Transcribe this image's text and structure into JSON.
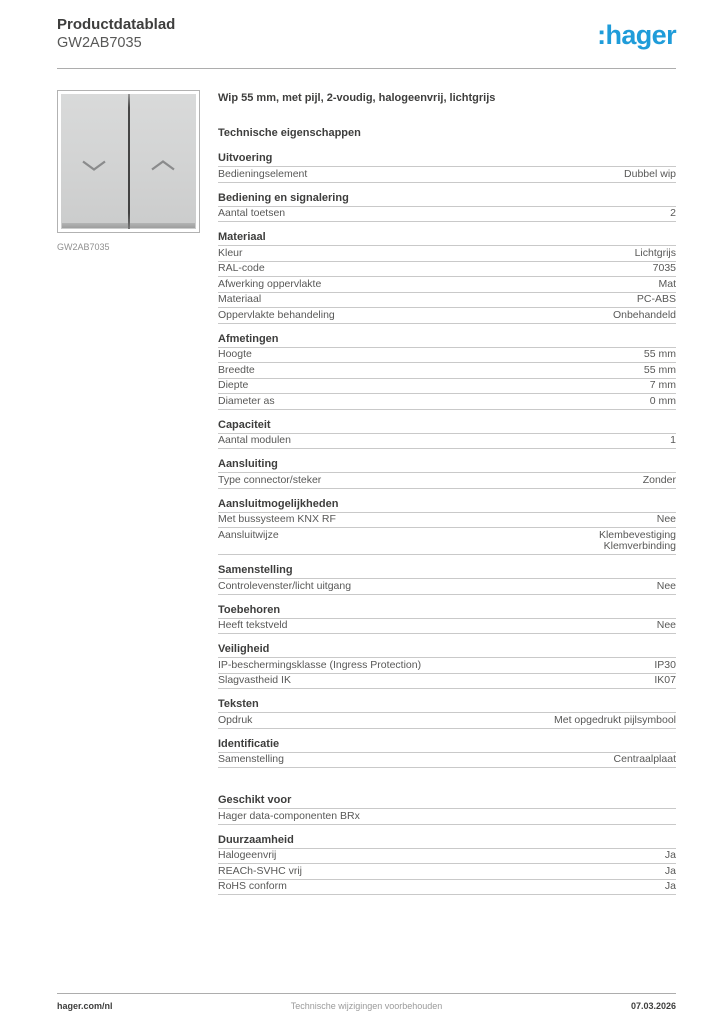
{
  "header": {
    "title": "Productdatablad",
    "product_code": "GW2AB7035",
    "logo": ":hager"
  },
  "product": {
    "image_caption": "GW2AB7035",
    "image_icons": [
      "chevron-down-icon",
      "chevron-up-icon"
    ],
    "description": "Wip 55 mm, met pijl, 2-voudig, halogeenvrij, lichtgrijs",
    "tech_title": "Technische eigenschappen"
  },
  "sections": [
    {
      "title": "Uitvoering",
      "rows": [
        {
          "label": "Bedieningselement",
          "value": "Dubbel wip"
        }
      ]
    },
    {
      "title": "Bediening en signalering",
      "rows": [
        {
          "label": "Aantal toetsen",
          "value": "2"
        }
      ]
    },
    {
      "title": "Materiaal",
      "rows": [
        {
          "label": "Kleur",
          "value": "Lichtgrijs"
        },
        {
          "label": "RAL-code",
          "value": "7035"
        },
        {
          "label": "Afwerking oppervlakte",
          "value": "Mat"
        },
        {
          "label": "Materiaal",
          "value": "PC-ABS"
        },
        {
          "label": "Oppervlakte behandeling",
          "value": "Onbehandeld"
        }
      ]
    },
    {
      "title": "Afmetingen",
      "rows": [
        {
          "label": "Hoogte",
          "value": "55 mm"
        },
        {
          "label": "Breedte",
          "value": "55 mm"
        },
        {
          "label": "Diepte",
          "value": "7 mm"
        },
        {
          "label": "Diameter as",
          "value": "0 mm"
        }
      ]
    },
    {
      "title": "Capaciteit",
      "rows": [
        {
          "label": "Aantal modulen",
          "value": "1"
        }
      ]
    },
    {
      "title": "Aansluiting",
      "rows": [
        {
          "label": "Type connector/steker",
          "value": "Zonder"
        }
      ]
    },
    {
      "title": "Aansluitmogelijkheden",
      "rows": [
        {
          "label": "Met bussysteem KNX RF",
          "value": "Nee"
        },
        {
          "label": "Aansluitwijze",
          "value": "Klembevestiging\nKlemverbinding"
        }
      ]
    },
    {
      "title": "Samenstelling",
      "rows": [
        {
          "label": "Controlevenster/licht uitgang",
          "value": "Nee"
        }
      ]
    },
    {
      "title": "Toebehoren",
      "rows": [
        {
          "label": "Heeft tekstveld",
          "value": "Nee"
        }
      ]
    },
    {
      "title": "Veiligheid",
      "rows": [
        {
          "label": "IP-beschermingsklasse (Ingress Protection)",
          "value": "IP30"
        },
        {
          "label": "Slagvastheid IK",
          "value": "IK07"
        }
      ]
    },
    {
      "title": "Teksten",
      "rows": [
        {
          "label": "Opdruk",
          "value": "Met opgedrukt pijlsymbool"
        }
      ]
    },
    {
      "title": "Identificatie",
      "rows": [
        {
          "label": "Samenstelling",
          "value": "Centraalplaat"
        }
      ]
    },
    {
      "title": "Geschikt voor",
      "extra_gap": true,
      "rows": [
        {
          "label": "Hager data-componenten BRx",
          "value": ""
        }
      ]
    },
    {
      "title": "Duurzaamheid",
      "rows": [
        {
          "label": "Halogeenvrij",
          "value": "Ja"
        },
        {
          "label": "REACh-SVHC vrij",
          "value": "Ja"
        },
        {
          "label": "RoHS conform",
          "value": "Ja"
        }
      ]
    }
  ],
  "footer": {
    "left": "hager.com/nl",
    "center": "Technische wijzigingen voorbehouden",
    "right": "07.03.2026"
  },
  "colors": {
    "brand_blue": "#1f9cd9",
    "text_dark": "#3e3e3d",
    "text_gray": "#585857",
    "rule_gray": "#c9c9c9",
    "switch_gray": "#d2d3d3"
  }
}
